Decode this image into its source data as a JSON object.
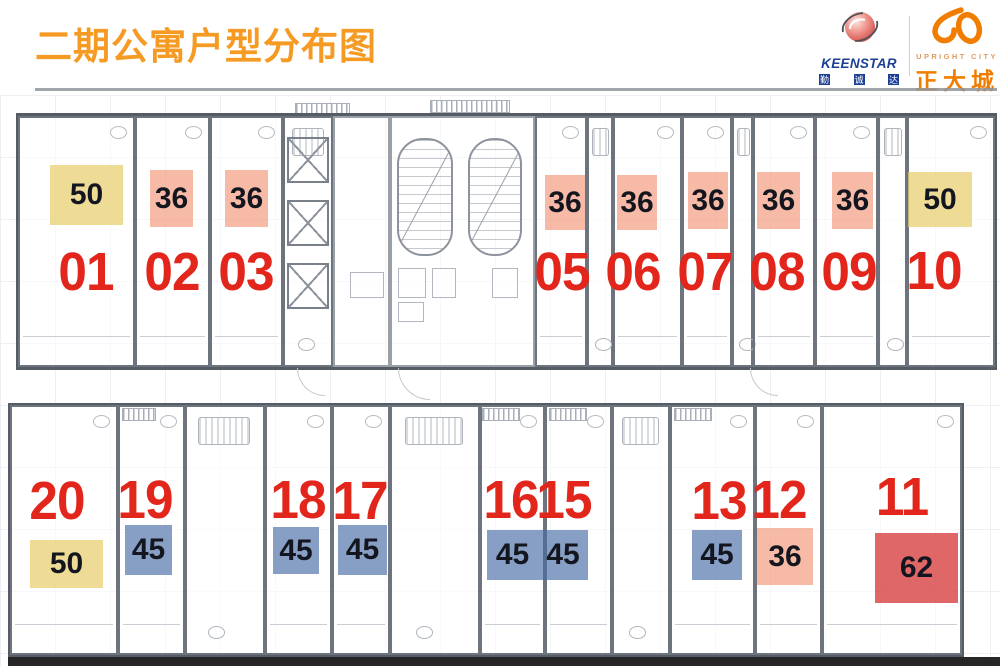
{
  "header": {
    "title": "二期公寓户型分布图",
    "keenstar": {
      "name": "KEENSTAR",
      "cn": [
        "勤",
        "诚",
        "达"
      ]
    },
    "upright": {
      "tagline": "UPRIGHT CITY",
      "name": "正大城"
    }
  },
  "colors": {
    "title_orange": "#F59A23",
    "brand_blue": "#1C3F94",
    "brand_orange": "#F07D00",
    "unit_number_red": "#E2261B",
    "area_36_salmon": "#F2AE97",
    "area_45_blue": "#8FA6C9",
    "area_50_yellow": "#ECDC9E",
    "area_62_red": "#DD5A5A"
  },
  "plan": {
    "top_row": [
      {
        "no": "01",
        "area": "50"
      },
      {
        "no": "02",
        "area": "36"
      },
      {
        "no": "03",
        "area": "36"
      },
      {
        "no": "05",
        "area": "36"
      },
      {
        "no": "06",
        "area": "36"
      },
      {
        "no": "07",
        "area": "36"
      },
      {
        "no": "08",
        "area": "36"
      },
      {
        "no": "09",
        "area": "36"
      },
      {
        "no": "10",
        "area": "50"
      }
    ],
    "bottom_row": [
      {
        "no": "20",
        "area": "50"
      },
      {
        "no": "19",
        "area": "45"
      },
      {
        "no": "18",
        "area": "45"
      },
      {
        "no": "17",
        "area": "45"
      },
      {
        "no": "16",
        "area": "45"
      },
      {
        "no": "15",
        "area": "45"
      },
      {
        "no": "13",
        "area": "45"
      },
      {
        "no": "12",
        "area": "36"
      },
      {
        "no": "11",
        "area": "62"
      }
    ]
  }
}
